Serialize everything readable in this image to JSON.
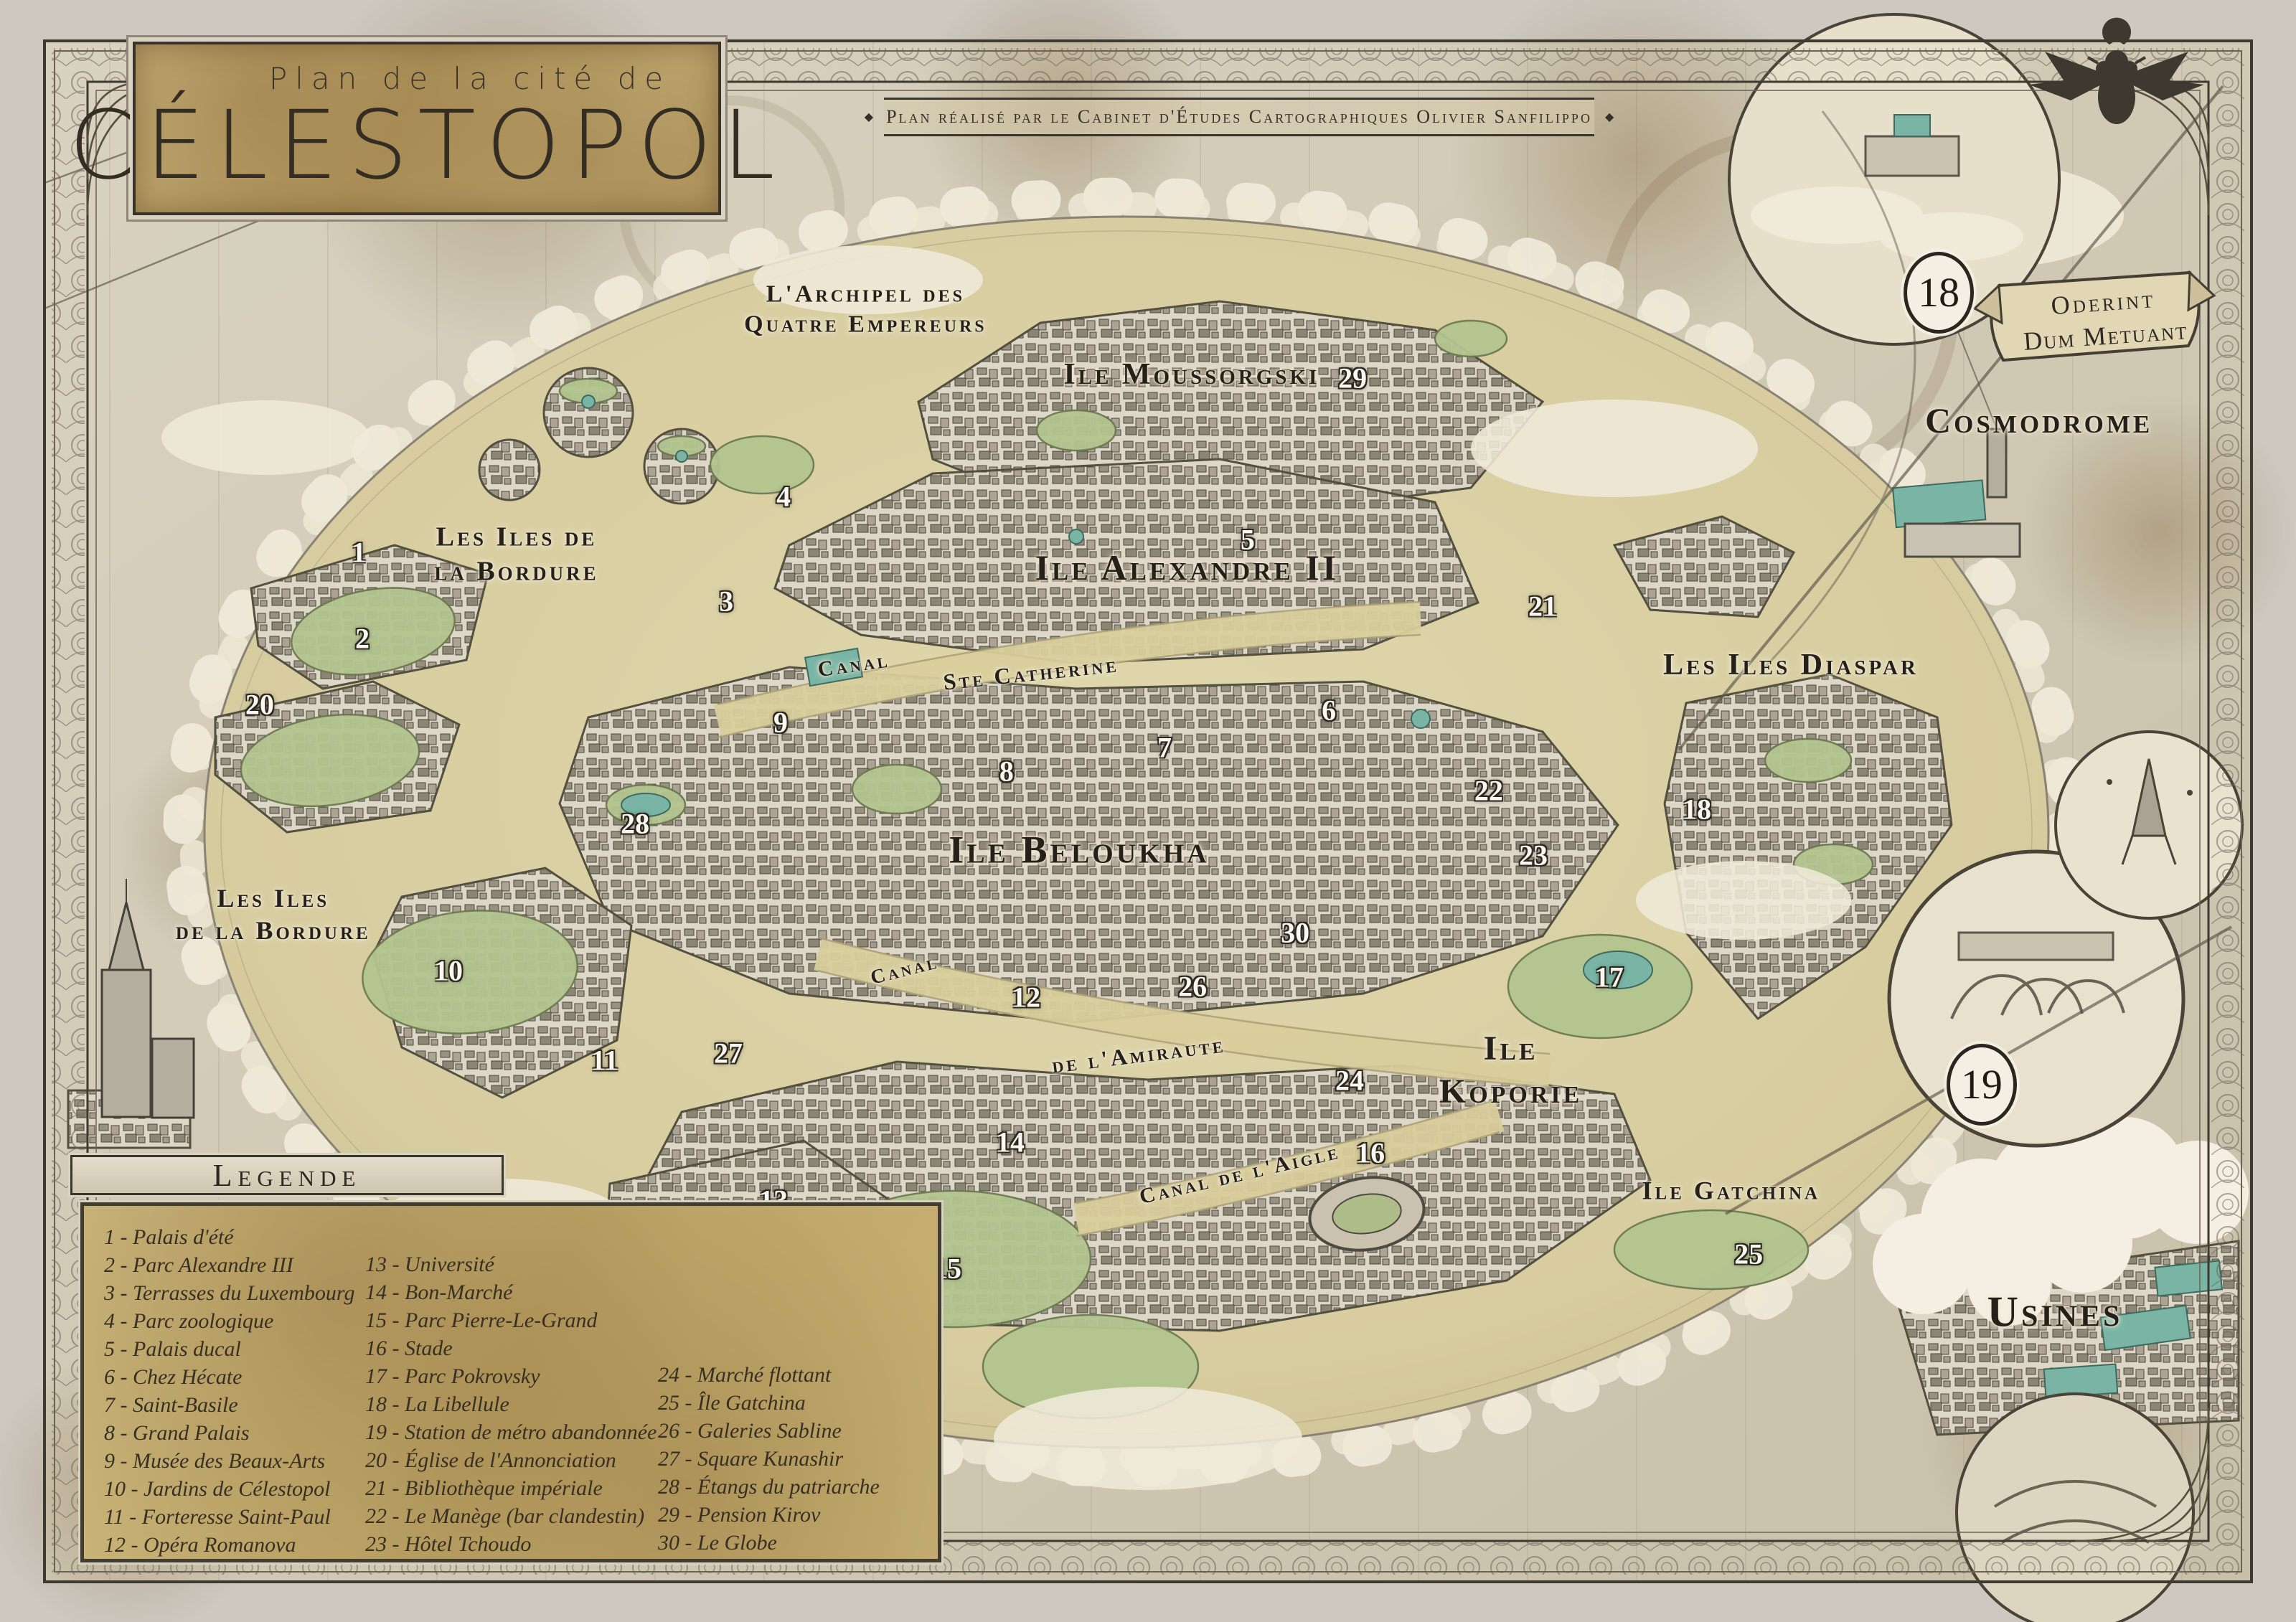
{
  "title": {
    "kicker": "Plan de la cité de",
    "name": "CÉLESTOPOL"
  },
  "subtitle": {
    "text": "Plan réalisé par le Cabinet d'Études Cartographiques Olivier Sanfilippo",
    "ornament": "◆"
  },
  "motto": {
    "line1": "Oderint",
    "line2": "Dum Metuant"
  },
  "legend": {
    "header": "Legende",
    "columns": [
      [
        "1 - Palais d'été",
        "2 - Parc Alexandre III",
        "3 - Terrasses du Luxembourg",
        "4 - Parc zoologique",
        "5 - Palais ducal",
        "6 - Chez Hécate",
        "7 - Saint-Basile",
        "8 - Grand Palais",
        "9 - Musée des Beaux-Arts",
        "10 - Jardins de Célestopol",
        "11 - Forteresse Saint-Paul",
        "12 - Opéra Romanova"
      ],
      [
        "13 - Université",
        "14 - Bon-Marché",
        "15 - Parc Pierre-Le-Grand",
        "16 - Stade",
        "17 - Parc Pokrovsky",
        "18 - La Libellule",
        "19 - Station de métro abandonnée",
        "20 - Église de l'Annonciation",
        "21 - Bibliothèque impériale",
        "22 - Le Manège (bar clandestin)",
        "23 - Hôtel Tchoudo"
      ],
      [
        "24 - Marché flottant",
        "25 - Île Gatchina",
        "26 - Galeries Sabline",
        "27 - Square Kunashir",
        "28 - Étangs du patriarche",
        "29 - Pension Kirov",
        "30 - Le Globe"
      ]
    ]
  },
  "regions": [
    {
      "id": "archipel",
      "text": "L'Archipel des\nQuatre Empereurs",
      "x": 37.7,
      "y": 19.1,
      "size": 34,
      "rot": 0
    },
    {
      "id": "moussorgski",
      "text": "Ile Moussorgski",
      "x": 51.9,
      "y": 23.1,
      "size": 42,
      "rot": 0
    },
    {
      "id": "bordure-north",
      "text": "Les Iles de\nla Bordure",
      "x": 22.5,
      "y": 34.2,
      "size": 38,
      "rot": 0
    },
    {
      "id": "alexandre",
      "text": "Ile Alexandre II",
      "x": 51.7,
      "y": 35.0,
      "size": 50,
      "rot": 0
    },
    {
      "id": "diaspar",
      "text": "Les Iles Diaspar",
      "x": 78.0,
      "y": 41.0,
      "size": 42,
      "rot": 0
    },
    {
      "id": "canal-west",
      "text": "Canal",
      "x": 37.2,
      "y": 41.0,
      "size": 30,
      "rot": -8
    },
    {
      "id": "ste-catherine",
      "text": "Ste Catherine",
      "x": 44.9,
      "y": 41.5,
      "size": 32,
      "rot": -6
    },
    {
      "id": "beloukha",
      "text": "Ile Beloukha",
      "x": 47.0,
      "y": 52.4,
      "size": 54,
      "rot": 0
    },
    {
      "id": "bordure-south",
      "text": "Les Iles\nde la Bordure",
      "x": 11.9,
      "y": 56.4,
      "size": 36,
      "rot": 0
    },
    {
      "id": "canal-south",
      "text": "Canal",
      "x": 39.4,
      "y": 59.8,
      "size": 28,
      "rot": -14
    },
    {
      "id": "amiraute",
      "text": "de l'Amiraute",
      "x": 49.6,
      "y": 65.0,
      "size": 32,
      "rot": -7
    },
    {
      "id": "koporie",
      "text": "Ile\nKoporie",
      "x": 65.8,
      "y": 66.0,
      "size": 48,
      "rot": 0
    },
    {
      "id": "canal-aigle",
      "text": "Canal de l'Aigle",
      "x": 54.0,
      "y": 72.4,
      "size": 30,
      "rot": -13
    },
    {
      "id": "universite",
      "text": "L'Ile de l'Université",
      "x": 30.5,
      "y": 76.2,
      "size": 44,
      "rot": 0
    },
    {
      "id": "gatchina",
      "text": "Ile Gatchina",
      "x": 75.4,
      "y": 73.4,
      "size": 36,
      "rot": 0
    },
    {
      "id": "cosmodrome",
      "text": "Cosmodrome",
      "x": 88.8,
      "y": 25.9,
      "size": 50,
      "rot": 0
    },
    {
      "id": "usines",
      "text": "Usines",
      "x": 89.5,
      "y": 80.9,
      "size": 60,
      "rot": 0
    }
  ],
  "markers": [
    {
      "n": "1",
      "x": 15.63,
      "y": 34.06
    },
    {
      "n": "2",
      "x": 15.78,
      "y": 39.36
    },
    {
      "n": "3",
      "x": 31.63,
      "y": 37.06
    },
    {
      "n": "4",
      "x": 34.13,
      "y": 30.61
    },
    {
      "n": "5",
      "x": 54.34,
      "y": 33.26
    },
    {
      "n": "6",
      "x": 57.88,
      "y": 43.79
    },
    {
      "n": "7",
      "x": 50.72,
      "y": 46.08
    },
    {
      "n": "8",
      "x": 43.84,
      "y": 47.55
    },
    {
      "n": "9",
      "x": 34.0,
      "y": 44.55
    },
    {
      "n": "10",
      "x": 19.53,
      "y": 59.84
    },
    {
      "n": "11",
      "x": 26.34,
      "y": 65.37
    },
    {
      "n": "12",
      "x": 44.69,
      "y": 61.48
    },
    {
      "n": "13",
      "x": 33.69,
      "y": 73.99
    },
    {
      "n": "14",
      "x": 44.0,
      "y": 70.41
    },
    {
      "n": "15",
      "x": 41.25,
      "y": 78.2
    },
    {
      "n": "16",
      "x": 59.69,
      "y": 71.06
    },
    {
      "n": "17",
      "x": 70.09,
      "y": 60.24
    },
    {
      "n": "18",
      "x": 73.91,
      "y": 49.89
    },
    {
      "n": "20",
      "x": 11.31,
      "y": 43.43
    },
    {
      "n": "21",
      "x": 67.19,
      "y": 37.37
    },
    {
      "n": "22",
      "x": 64.84,
      "y": 48.75
    },
    {
      "n": "23",
      "x": 66.78,
      "y": 52.7
    },
    {
      "n": "24",
      "x": 58.78,
      "y": 66.6
    },
    {
      "n": "25",
      "x": 76.16,
      "y": 77.31
    },
    {
      "n": "26",
      "x": 51.94,
      "y": 60.81
    },
    {
      "n": "27",
      "x": 31.72,
      "y": 64.93
    },
    {
      "n": "28",
      "x": 27.66,
      "y": 50.77
    },
    {
      "n": "29",
      "x": 58.91,
      "y": 23.31
    },
    {
      "n": "30",
      "x": 56.41,
      "y": 57.5
    }
  ],
  "circled_markers": [
    {
      "n": "18",
      "x": 84.44,
      "y": 18.04
    },
    {
      "n": "19",
      "x": 86.31,
      "y": 66.87
    }
  ]
}
